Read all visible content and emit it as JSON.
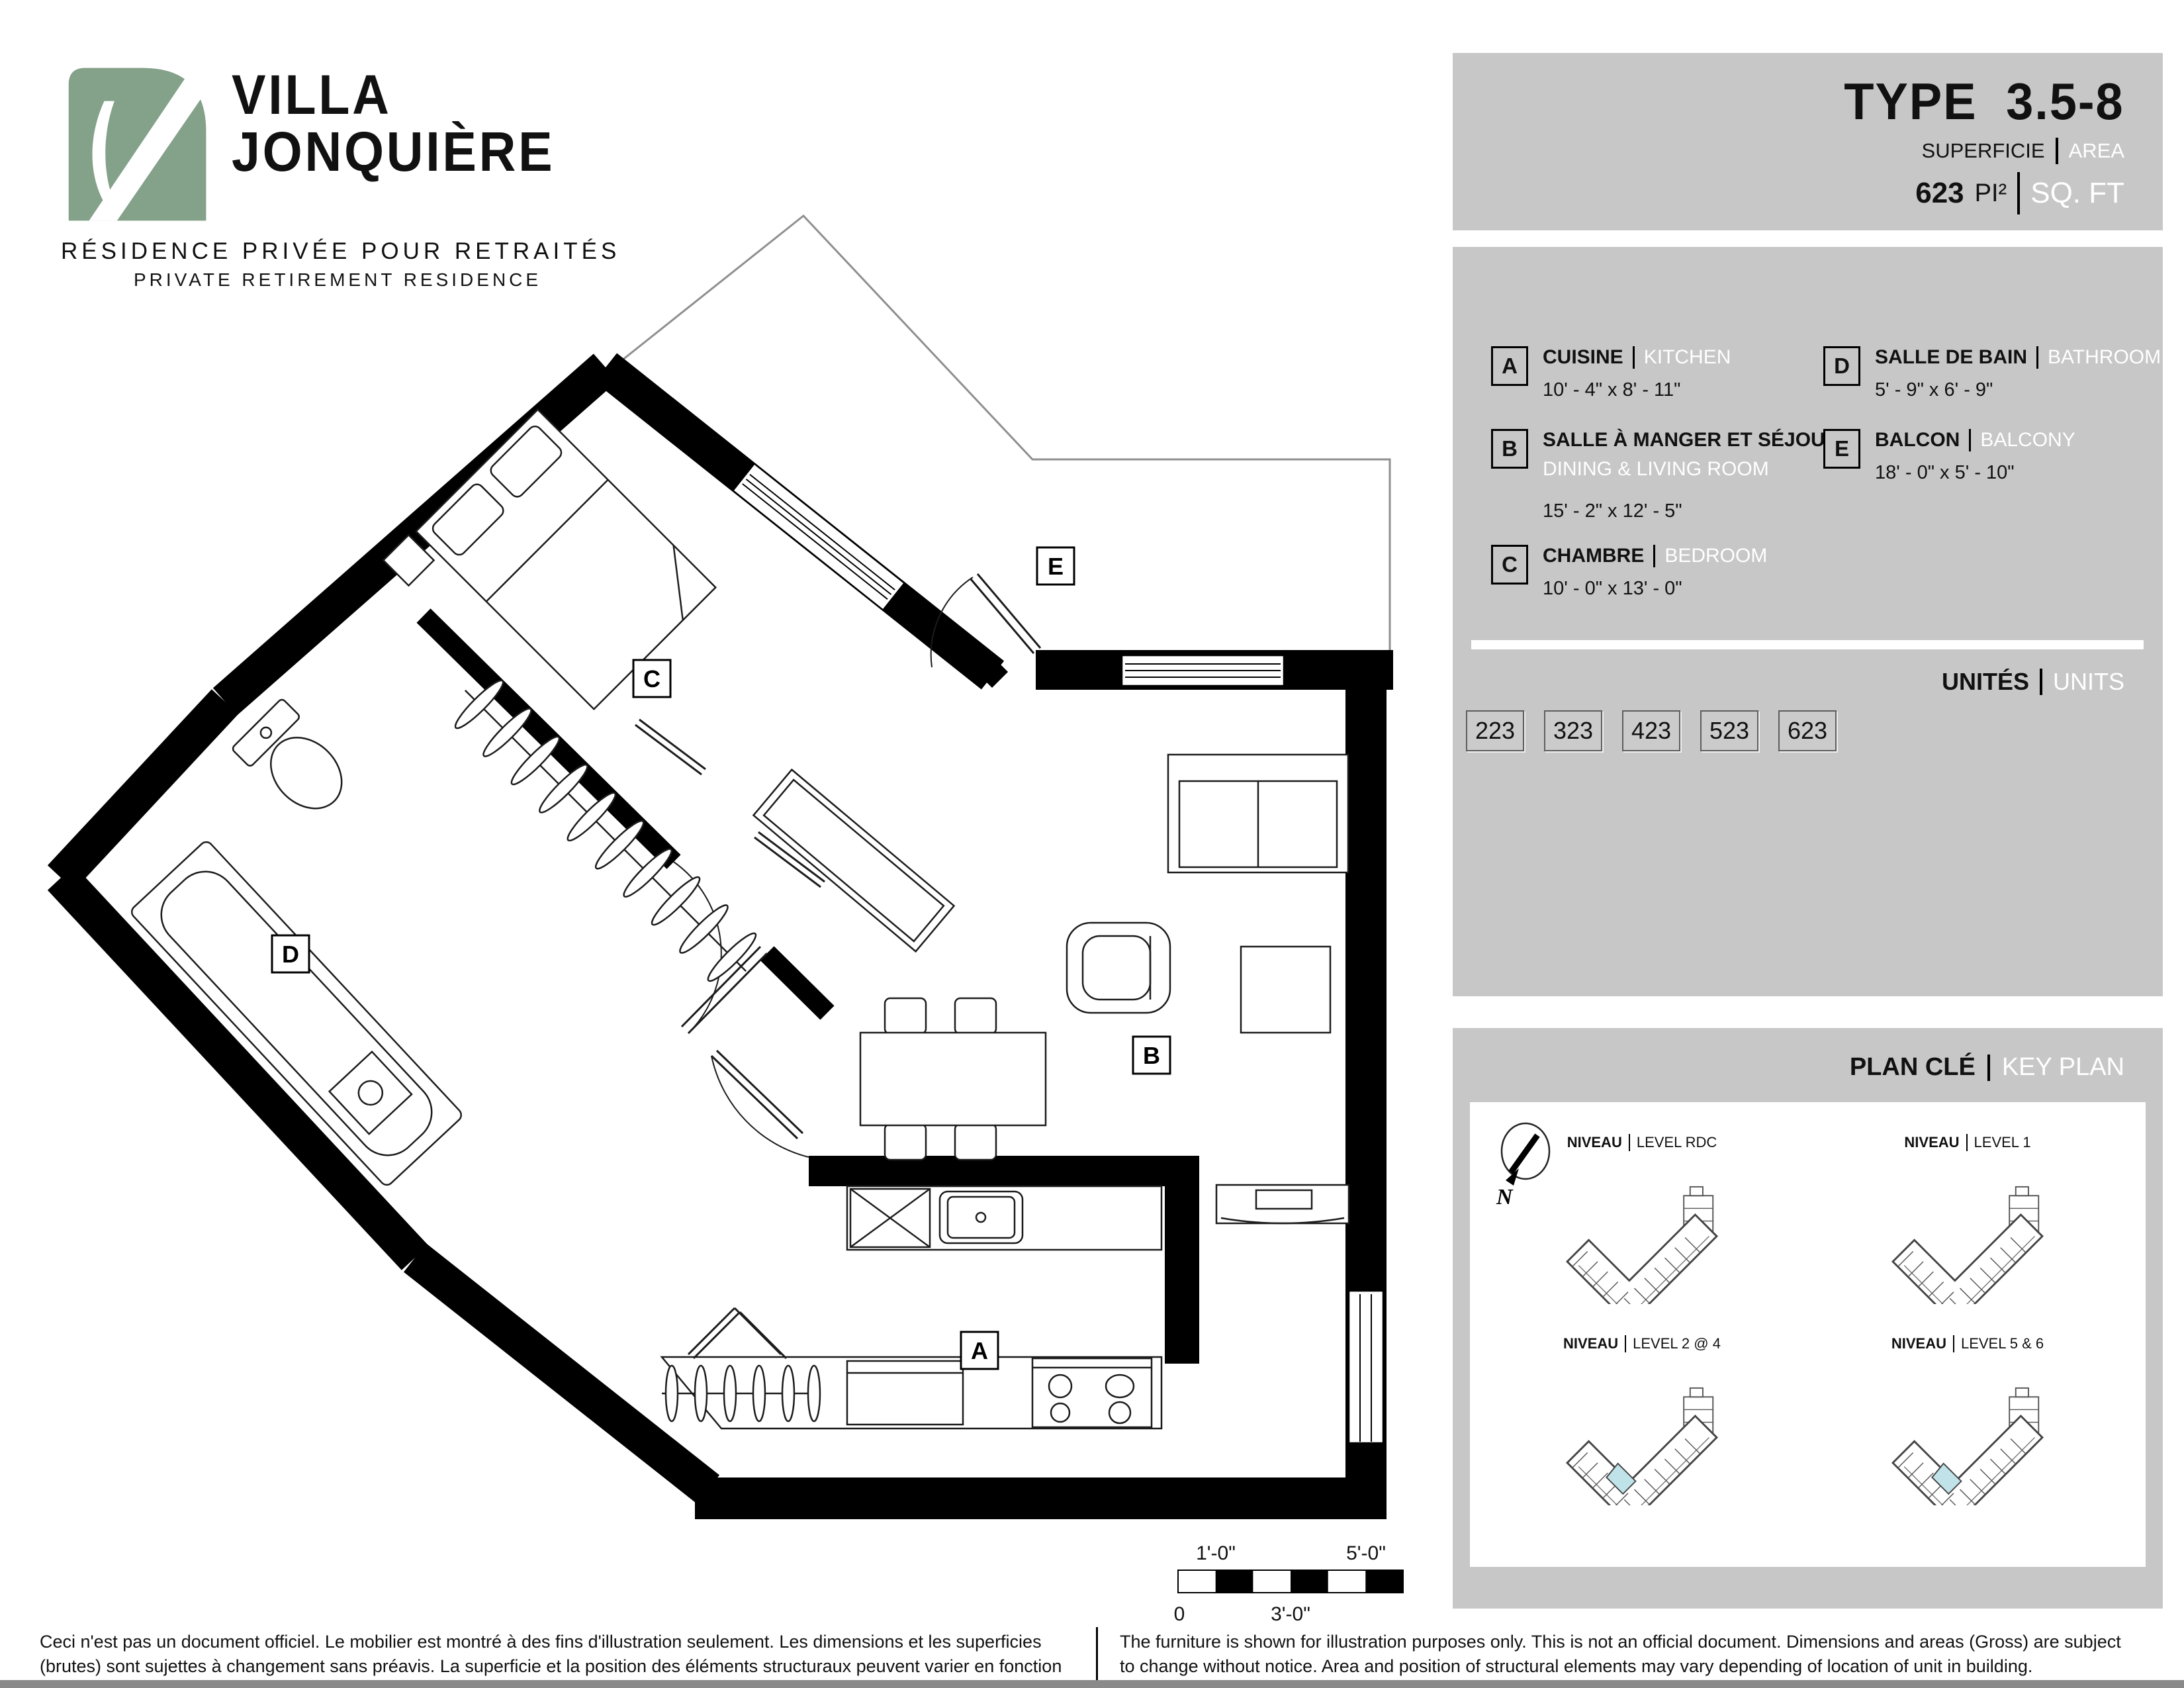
{
  "logo": {
    "line1": "VILLA",
    "line2": "JONQUIÈRE",
    "tagline_fr": "RÉSIDENCE PRIVÉE POUR RETRAITÉS",
    "tagline_en": "PRIVATE RETIREMENT RESIDENCE"
  },
  "type_panel": {
    "label": "TYPE",
    "value": "3.5-8",
    "superficie": "SUPERFICIE",
    "area": "AREA",
    "sqft_value": "623",
    "sqft_unit_fr": "PI²",
    "sqft_unit_en": "SQ. FT"
  },
  "legend": {
    "items": [
      {
        "code": "A",
        "fr": "CUISINE",
        "en": "KITCHEN",
        "dim": "10' - 4\" x 8' - 11\""
      },
      {
        "code": "B",
        "fr": "SALLE À MANGER ET SÉJOUR",
        "en": "DINING & LIVING ROOM",
        "dim": "15' - 2\" x 12' - 5\""
      },
      {
        "code": "C",
        "fr": "CHAMBRE",
        "en": "BEDROOM",
        "dim": "10' - 0\" x 13' - 0\""
      },
      {
        "code": "D",
        "fr": "SALLE DE BAIN",
        "en": "BATHROOM",
        "dim": "5' - 9\" x 6' - 9\""
      },
      {
        "code": "E",
        "fr": "BALCON",
        "en": "BALCONY",
        "dim": "18' - 0\" x 5' - 10\""
      }
    ],
    "units_fr": "UNITÉS",
    "units_en": "UNITS",
    "unit_numbers": [
      "223",
      "323",
      "423",
      "523",
      "623"
    ]
  },
  "keyplan": {
    "title_fr": "PLAN CLÉ",
    "title_en": "KEY PLAN",
    "levels": [
      {
        "fr": "NIVEAU",
        "en": "LEVEL RDC"
      },
      {
        "fr": "NIVEAU",
        "en": "LEVEL 1"
      },
      {
        "fr": "NIVEAU",
        "en": "LEVEL 2 @ 4"
      },
      {
        "fr": "NIVEAU",
        "en": "LEVEL 5 & 6"
      }
    ],
    "north": "N"
  },
  "plan": {
    "labels": {
      "a": "A",
      "b": "B",
      "c": "C",
      "d": "D",
      "e": "E"
    },
    "scale": {
      "t1": "1'-0\"",
      "t2": "5'-0\"",
      "b1": "0",
      "b2": "3'-0\""
    }
  },
  "footer": {
    "fr": "Ceci n'est pas un document officiel.  Le mobilier est montré à des fins d'illustration seulement.  Les dimensions et les superficies (brutes) sont sujettes à changement sans préavis. La superficie et la position des éléments structuraux peuvent varier en fonction de l'emplacement de l'unité dans le bâtiment.",
    "en": "The furniture is shown for illustration purposes only.  This is not an official document.  Dimensions and areas (Gross) are subject to change without notice.  Area and position of structural elements may vary depending of location of unit in building."
  },
  "colors": {
    "brand_green": "#84a189",
    "panel_gray": "#c7c7c7",
    "highlight_cyan": "#bfe3e8"
  }
}
